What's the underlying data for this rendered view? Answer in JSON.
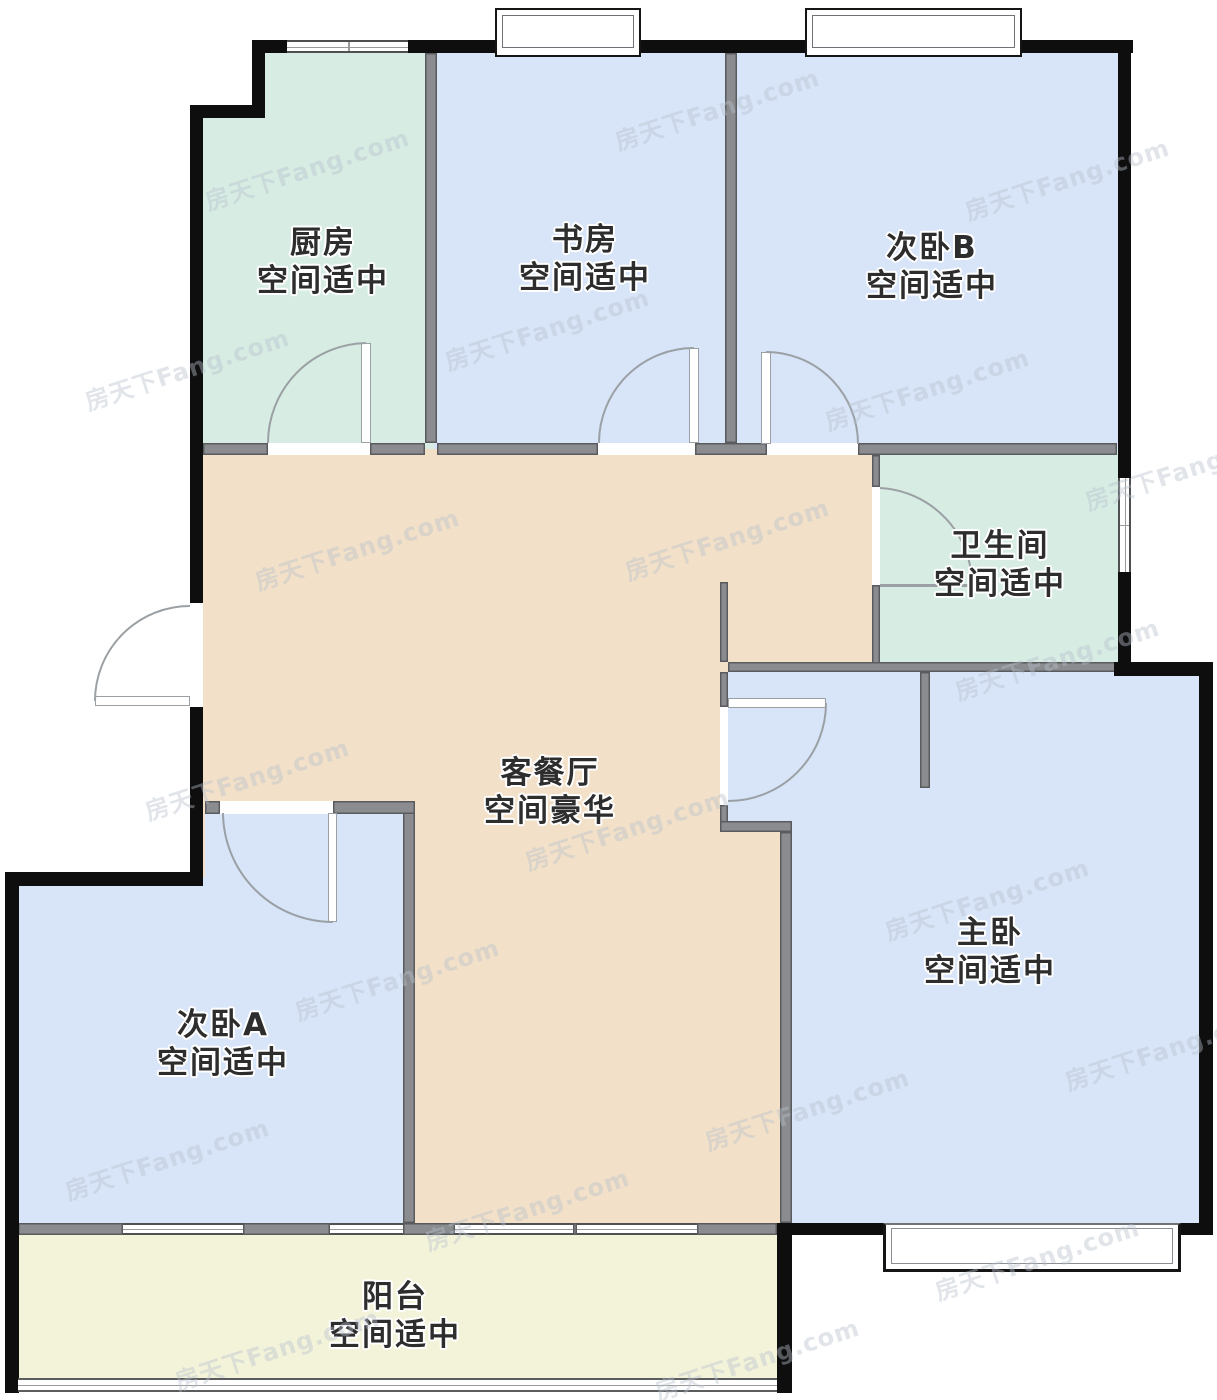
{
  "watermark": {
    "text": "房天下Fang.com"
  },
  "rooms": {
    "kitchen": {
      "name": "厨房",
      "desc": "空间适中"
    },
    "study": {
      "name": "书房",
      "desc": "空间适中"
    },
    "bedroom_b": {
      "name": "次卧B",
      "desc": "空间适中"
    },
    "bathroom": {
      "name": "卫生间",
      "desc": "空间适中"
    },
    "living_dining": {
      "name": "客餐厅",
      "desc": "空间豪华"
    },
    "master_bedroom": {
      "name": "主卧",
      "desc": "空间适中"
    },
    "bedroom_a": {
      "name": "次卧A",
      "desc": "空间适中"
    },
    "balcony": {
      "name": "阳台",
      "desc": "空间适中"
    }
  },
  "colors": {
    "room_blue": "#d8e4f8",
    "room_green": "#d7ede3",
    "room_tan": "#f2e0c8",
    "room_cream": "#f3f3da",
    "wall_black": "#0e0e0e",
    "wall_gray": "#8a8c8f"
  }
}
